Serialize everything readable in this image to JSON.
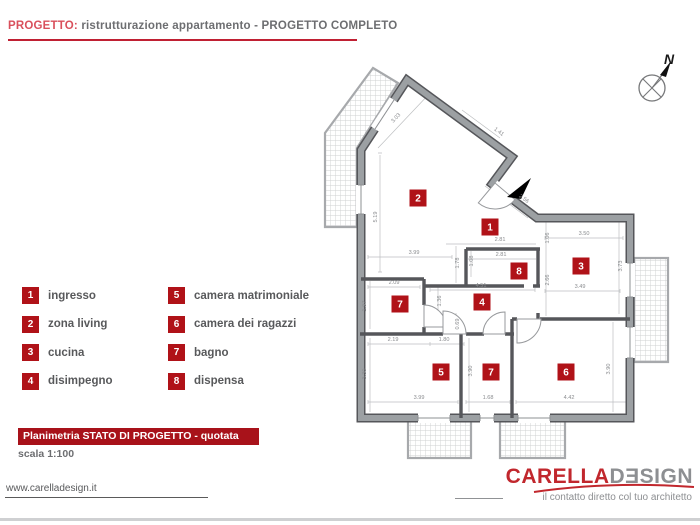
{
  "header": {
    "label": "PROGETTO:",
    "title": " ristrutturazione appartamento - PROGETTO COMPLETO"
  },
  "legend": {
    "items": [
      {
        "num": "1",
        "label": "ingresso"
      },
      {
        "num": "2",
        "label": "zona living"
      },
      {
        "num": "3",
        "label": "cucina"
      },
      {
        "num": "4",
        "label": "disimpegno"
      },
      {
        "num": "5",
        "label": "camera matrimoniale"
      },
      {
        "num": "6",
        "label": "camera dei ragazzi"
      },
      {
        "num": "7",
        "label": "bagno"
      },
      {
        "num": "8",
        "label": "dispensa"
      }
    ]
  },
  "plan": {
    "rooms": [
      {
        "num": "2",
        "x": 418,
        "y": 198
      },
      {
        "num": "1",
        "x": 490,
        "y": 227
      },
      {
        "num": "8",
        "x": 519,
        "y": 271
      },
      {
        "num": "3",
        "x": 581,
        "y": 266
      },
      {
        "num": "7",
        "x": 400,
        "y": 304
      },
      {
        "num": "4",
        "x": 482,
        "y": 302
      },
      {
        "num": "5",
        "x": 441,
        "y": 372
      },
      {
        "num": "7",
        "x": 491,
        "y": 372
      },
      {
        "num": "6",
        "x": 566,
        "y": 372
      }
    ],
    "dims": [
      {
        "t": "3.03",
        "x": 397,
        "y": 119,
        "rot": -47
      },
      {
        "t": "1.41",
        "x": 498,
        "y": 133,
        "rot": 37
      },
      {
        "t": "2.56",
        "x": 523,
        "y": 200,
        "rot": 37
      },
      {
        "t": "5.19",
        "x": 377,
        "y": 217,
        "rot": -90
      },
      {
        "t": "3.50",
        "x": 584,
        "y": 235,
        "rot": 0
      },
      {
        "t": "2.81",
        "x": 500,
        "y": 241,
        "rot": 0
      },
      {
        "t": "1.06",
        "x": 549,
        "y": 238,
        "rot": -90
      },
      {
        "t": "3.99",
        "x": 414,
        "y": 254,
        "rot": 0
      },
      {
        "t": "2.81",
        "x": 501,
        "y": 256,
        "rot": 0
      },
      {
        "t": "1.78",
        "x": 459,
        "y": 263,
        "rot": -90
      },
      {
        "t": "1.08",
        "x": 473,
        "y": 261,
        "rot": -90
      },
      {
        "t": "2.66",
        "x": 549,
        "y": 280,
        "rot": -90
      },
      {
        "t": "3.73",
        "x": 622,
        "y": 266,
        "rot": -90
      },
      {
        "t": "3.49",
        "x": 580,
        "y": 288,
        "rot": 0
      },
      {
        "t": "2.09",
        "x": 394,
        "y": 284,
        "rot": 0
      },
      {
        "t": "4.51",
        "x": 481,
        "y": 287,
        "rot": 0
      },
      {
        "t": "1.97",
        "x": 366,
        "y": 306,
        "rot": -90
      },
      {
        "t": "1.36",
        "x": 441,
        "y": 301,
        "rot": -90
      },
      {
        "t": "0.69",
        "x": 459,
        "y": 324,
        "rot": -90
      },
      {
        "t": "2.19",
        "x": 393,
        "y": 341,
        "rot": 0
      },
      {
        "t": "1.80",
        "x": 444,
        "y": 341,
        "rot": 0
      },
      {
        "t": "3.30",
        "x": 366,
        "y": 374,
        "rot": -90
      },
      {
        "t": "3.90",
        "x": 472,
        "y": 371,
        "rot": -90
      },
      {
        "t": "3.90",
        "x": 610,
        "y": 369,
        "rot": -90
      },
      {
        "t": "3.99",
        "x": 419,
        "y": 399,
        "rot": 0
      },
      {
        "t": "1.68",
        "x": 488,
        "y": 399,
        "rot": 0
      },
      {
        "t": "4.42",
        "x": 569,
        "y": 399,
        "rot": 0
      }
    ]
  },
  "titleblock": {
    "line1": "Planimetria STATO DI PROGETTO - quotata",
    "line2": "scala 1:100"
  },
  "footer": {
    "url": "www.carelladesign.it",
    "brand_red": "CARELLA",
    "brand_gray": "DƎSIGN",
    "tagline": "il contatto diretto col tuo architetto"
  },
  "compass": {
    "label": "N"
  },
  "colors": {
    "accent_red": "#b01218",
    "title_bar_red": "#a8121a",
    "header_red": "#d9505c",
    "rule_red": "#c02033",
    "logo_red": "#c1272d",
    "text_gray": "#58595b",
    "wall_gray": "#9ca0a3",
    "wall_edge": "#55565a"
  }
}
